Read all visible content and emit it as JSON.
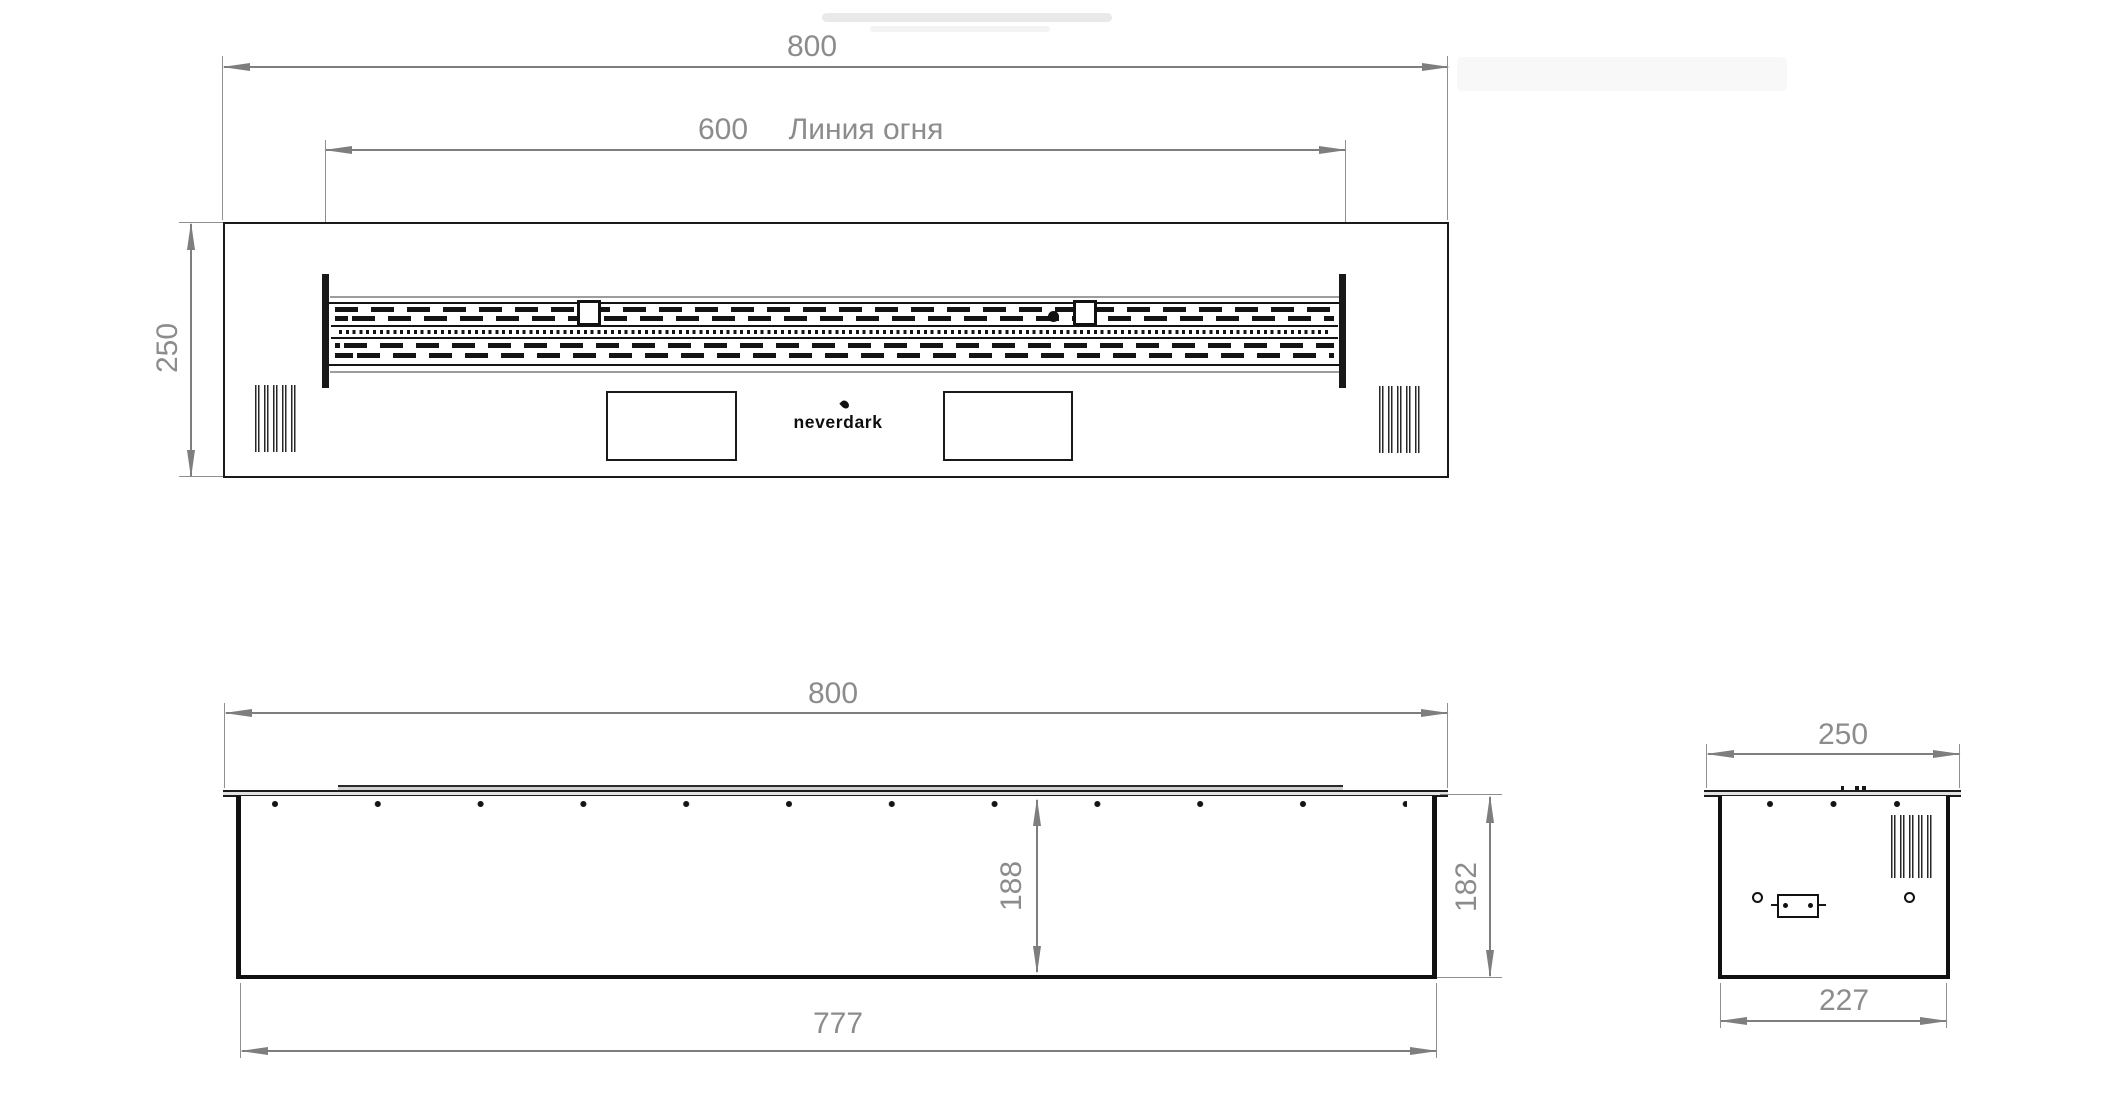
{
  "brand": {
    "logo_text": "neverdark"
  },
  "views": {
    "top": {
      "overall_width": "800",
      "fire_line_length": "600",
      "fire_line_label": "Линия огня",
      "depth": "250"
    },
    "front": {
      "overall_width": "800",
      "inner_depth": "188",
      "height": "182",
      "body_width": "777"
    },
    "side": {
      "overall_depth": "250",
      "body_depth": "227"
    }
  }
}
